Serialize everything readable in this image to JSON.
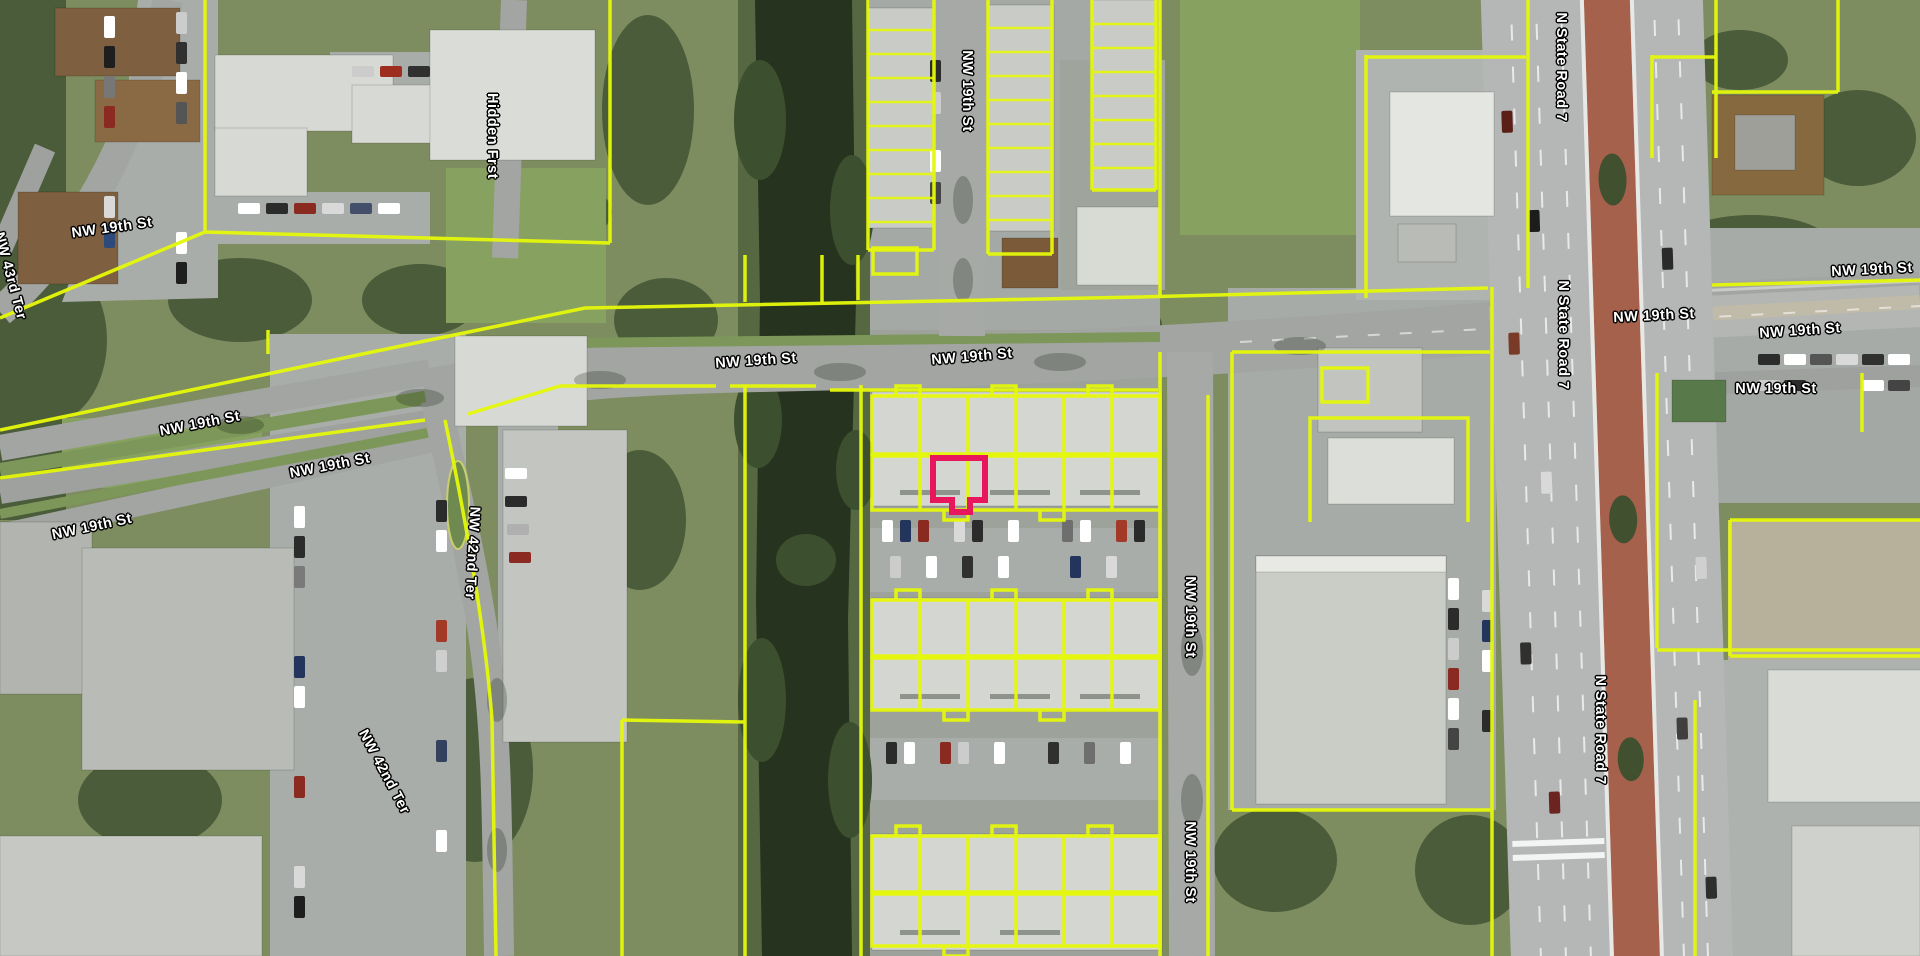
{
  "map": {
    "type": "aerial-parcel-map",
    "colors": {
      "parcel_line": "#e4f70a",
      "selected_parcel": "#e8175d",
      "label_text": "#ffffff",
      "label_outline": "#000000",
      "canal_water": "#26331e",
      "road": "#a2a5a2",
      "highway_median": "#a5614b"
    },
    "selected_parcel": {
      "note": "highlighted townhouse unit outline"
    },
    "labels": [
      {
        "text": "NW 19th St",
        "x": 112,
        "y": 228,
        "rot": -8
      },
      {
        "text": "NW 43rd Ter",
        "x": 10,
        "y": 276,
        "rot": 75
      },
      {
        "text": "Hidden Frst",
        "x": 492,
        "y": 136,
        "rot": 90
      },
      {
        "text": "NW 19th St",
        "x": 200,
        "y": 424,
        "rot": -11
      },
      {
        "text": "NW 19th St",
        "x": 330,
        "y": 466,
        "rot": -11
      },
      {
        "text": "NW 19th St",
        "x": 92,
        "y": 527,
        "rot": -12
      },
      {
        "text": "NW 19th St",
        "x": 756,
        "y": 361,
        "rot": -4
      },
      {
        "text": "NW 19th St",
        "x": 972,
        "y": 357,
        "rot": -5
      },
      {
        "text": "NW 19th St",
        "x": 967,
        "y": 91,
        "rot": 90
      },
      {
        "text": "NW 42nd Ter",
        "x": 472,
        "y": 553,
        "rot": 93
      },
      {
        "text": "NW 42nd Ter",
        "x": 384,
        "y": 772,
        "rot": 62
      },
      {
        "text": "NW 19th St",
        "x": 1190,
        "y": 617,
        "rot": 90
      },
      {
        "text": "NW 19th St",
        "x": 1190,
        "y": 862,
        "rot": 90
      },
      {
        "text": "NW 19th St",
        "x": 1654,
        "y": 316,
        "rot": -3
      },
      {
        "text": "NW 19th St",
        "x": 1800,
        "y": 331,
        "rot": -4
      },
      {
        "text": "NW 19th St",
        "x": 1776,
        "y": 389,
        "rot": 0
      },
      {
        "text": "NW 19th St",
        "x": 1872,
        "y": 270,
        "rot": -3
      },
      {
        "text": "N State Road 7",
        "x": 1561,
        "y": 67,
        "rot": 90
      },
      {
        "text": "N State Road 7",
        "x": 1563,
        "y": 335,
        "rot": 90
      },
      {
        "text": "N State Road 7",
        "x": 1600,
        "y": 730,
        "rot": 90
      }
    ]
  }
}
